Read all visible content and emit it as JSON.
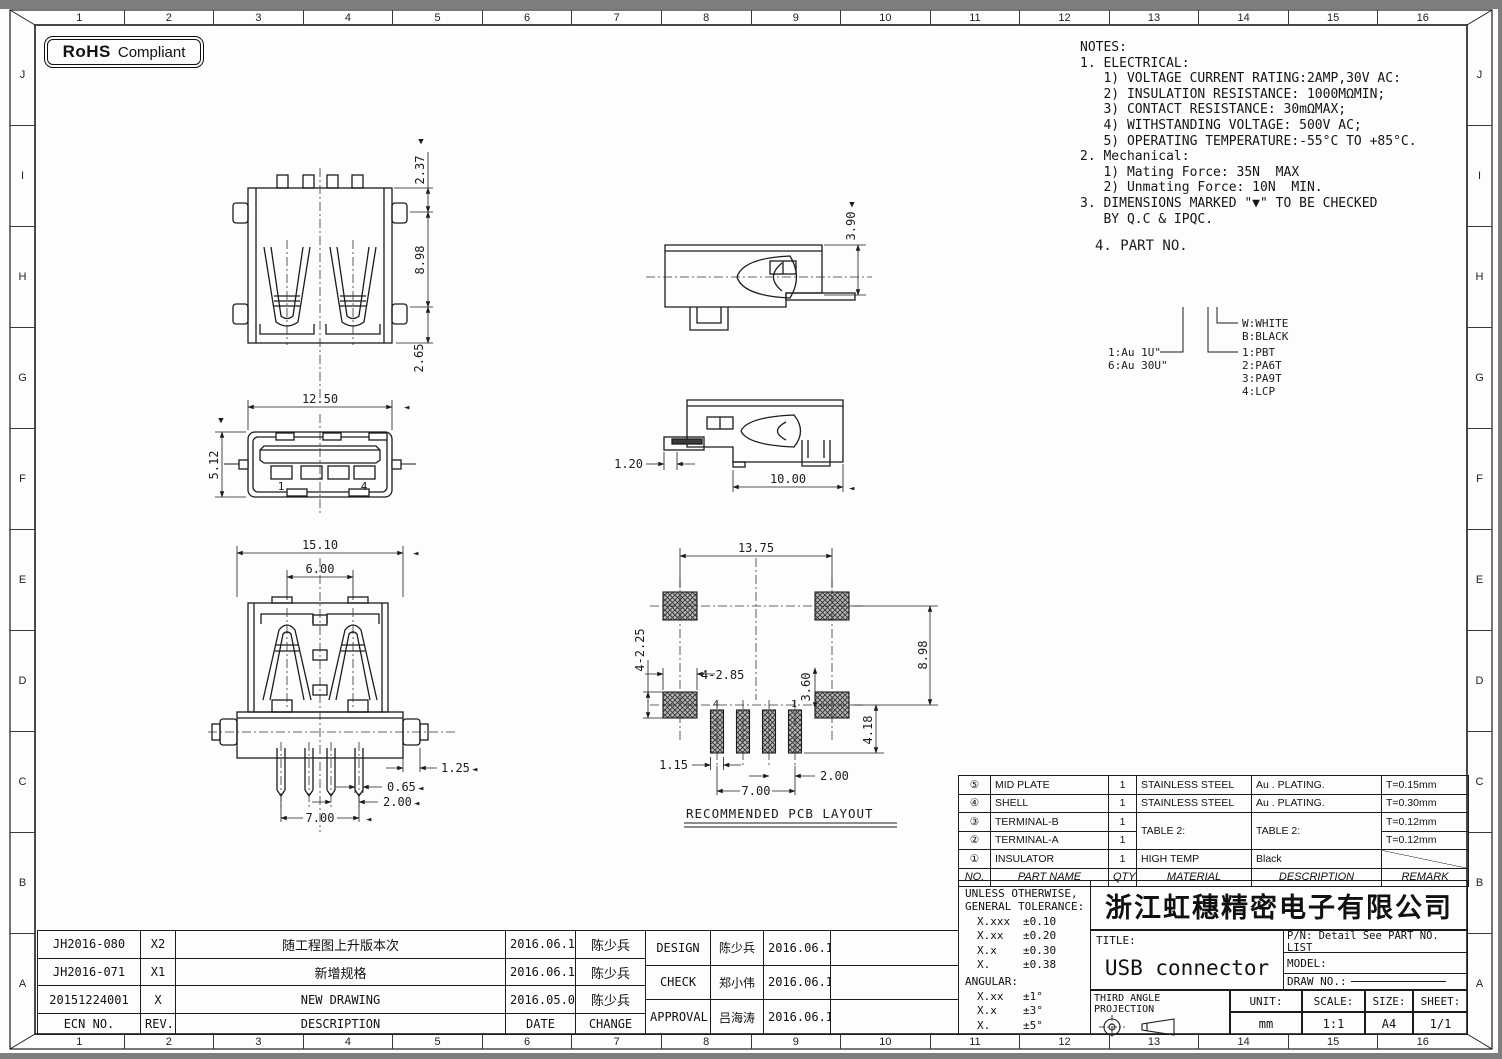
{
  "badge": {
    "rohs": "RoHS",
    "compliant": "Compliant"
  },
  "grid": {
    "cols": [
      "1",
      "2",
      "3",
      "4",
      "5",
      "6",
      "7",
      "8",
      "9",
      "10",
      "11",
      "12",
      "13",
      "14",
      "15",
      "16"
    ],
    "rows": [
      "J",
      "I",
      "H",
      "G",
      "F",
      "E",
      "D",
      "C",
      "B",
      "A"
    ]
  },
  "notes": {
    "lines": [
      "NOTES:",
      "1. ELECTRICAL:",
      "   1) VOLTAGE CURRENT RATING:2AMP,30V AC:",
      "   2) INSULATION RESISTANCE: 1000MΩMIN;",
      "   3) CONTACT RESISTANCE: 30mΩMAX;",
      "   4) WITHSTANDING VOLTAGE: 500V AC;",
      "   5) OPERATING TEMPERATURE:-55°C TO +85°C.",
      "2. Mechanical:",
      "   1) Mating Force: 35N  MAX",
      "   2) Unmating Force: 10N  MIN.",
      "3. DIMENSIONS MARKED \"▼\" TO BE CHECKED",
      "   BY Q.C & IPQC."
    ]
  },
  "legend": {
    "heading": "4. PART NO.",
    "plating": [
      "1:Au 1U\"",
      "6:Au 30U\""
    ],
    "colors": [
      "W:WHITE",
      "B:BLACK"
    ],
    "materials": [
      "1:PBT",
      "2:PA6T",
      "3:PA9T",
      "4:LCP"
    ]
  },
  "marks": {
    "down": "▼",
    "left": "◄"
  },
  "views": {
    "top": {
      "d1": "2.37",
      "d2": "8.98",
      "d3": "2.65"
    },
    "side_top": {
      "d1": "3.90"
    },
    "front": {
      "w": "12.50",
      "h": "5.12",
      "p1": "1",
      "p4": "4"
    },
    "side_mid": {
      "d1": "1.20",
      "d2": "10.00"
    },
    "bottom": {
      "d1": "15.10",
      "d2": "6.00",
      "d3": "1.25",
      "d4": "0.65",
      "d5": "2.00",
      "d6": "7.00"
    },
    "pcb": {
      "title": "RECOMMENDED PCB LAYOUT",
      "d1": "13.75",
      "d2": "4-2.25",
      "d3": "4-2.85",
      "d4": "8.98",
      "d5": "3.60",
      "d6": "4.18",
      "d7": "1.15",
      "d8": "2.00",
      "d9": "7.00",
      "p4": "4",
      "p1": "1"
    }
  },
  "bom": {
    "headers": {
      "no": "NO.",
      "part": "PART NAME",
      "qty": "QTY",
      "material": "MATERIAL",
      "desc": "DESCRIPTION",
      "remark": "REMARK"
    },
    "rows": [
      {
        "no": "⑤",
        "part": "MID PLATE",
        "qty": "1",
        "material": "STAINLESS STEEL",
        "desc": "Au . PLATING.",
        "remark": "T=0.15mm"
      },
      {
        "no": "④",
        "part": "SHELL",
        "qty": "1",
        "material": "STAINLESS STEEL",
        "desc": "Au . PLATING.",
        "remark": "T=0.30mm"
      },
      {
        "no": "③",
        "part": "TERMINAL-B",
        "qty": "1",
        "material": "TABLE 2:",
        "desc": "TABLE 2:",
        "remark": "T=0.12mm"
      },
      {
        "no": "②",
        "part": "TERMINAL-A",
        "qty": "1",
        "remark": "T=0.12mm"
      },
      {
        "no": "①",
        "part": "INSULATOR",
        "qty": "1",
        "material": "HIGH TEMP",
        "desc": "Black",
        "remark": ""
      }
    ]
  },
  "tolerance": {
    "line1": "UNLESS OTHERWISE,",
    "line2": "GENERAL TOLERANCE:",
    "rows": [
      [
        "X.xxx",
        "±0.10"
      ],
      [
        "X.xx",
        "±0.20"
      ],
      [
        "X.x",
        "±0.30"
      ],
      [
        "X.",
        "±0.38"
      ]
    ],
    "angular": "ANGULAR:",
    "angular_rows": [
      [
        "X.xx",
        "±1°"
      ],
      [
        "X.x",
        "±3°"
      ],
      [
        "X.",
        "±5°"
      ]
    ]
  },
  "title_block": {
    "company": "浙江虹穗精密电子有限公司",
    "title_label": "TITLE:",
    "title": "USB connector",
    "pn": "P/N: Detail See PART NO. LIST",
    "model_label": "MODEL:",
    "draw_label": "DRAW NO.:",
    "projection": "THIRD ANGLE PROJECTION",
    "unit_label": "UNIT:",
    "unit": "mm",
    "scale_label": "SCALE:",
    "scale": "1:1",
    "size_label": "SIZE:",
    "size": "A4",
    "sheet_label": "SHEET:",
    "sheet": "1/1"
  },
  "revisions": {
    "headers": {
      "ecn": "ECN NO.",
      "rev": "REV.",
      "desc": "DESCRIPTION",
      "date": "DATE",
      "change": "CHANGE"
    },
    "rows": [
      {
        "ecn": "JH2016-080",
        "rev": "X2",
        "desc": "随工程图上升版本次",
        "date": "2016.06.15",
        "change": "陈少兵"
      },
      {
        "ecn": "JH2016-071",
        "rev": "X1",
        "desc": "新增规格",
        "date": "2016.06.10",
        "change": "陈少兵"
      },
      {
        "ecn": "20151224001",
        "rev": "X",
        "desc": "NEW DRAWING",
        "date": "2016.05.05",
        "change": "陈少兵"
      }
    ]
  },
  "approvals": {
    "rows": [
      {
        "role": "DESIGN",
        "name": "陈少兵",
        "date": "2016.06.15"
      },
      {
        "role": "CHECK",
        "name": "郑小伟",
        "date": "2016.06.15"
      },
      {
        "role": "APPROVAL",
        "name": "吕海涛",
        "date": "2016.06.15"
      }
    ]
  }
}
